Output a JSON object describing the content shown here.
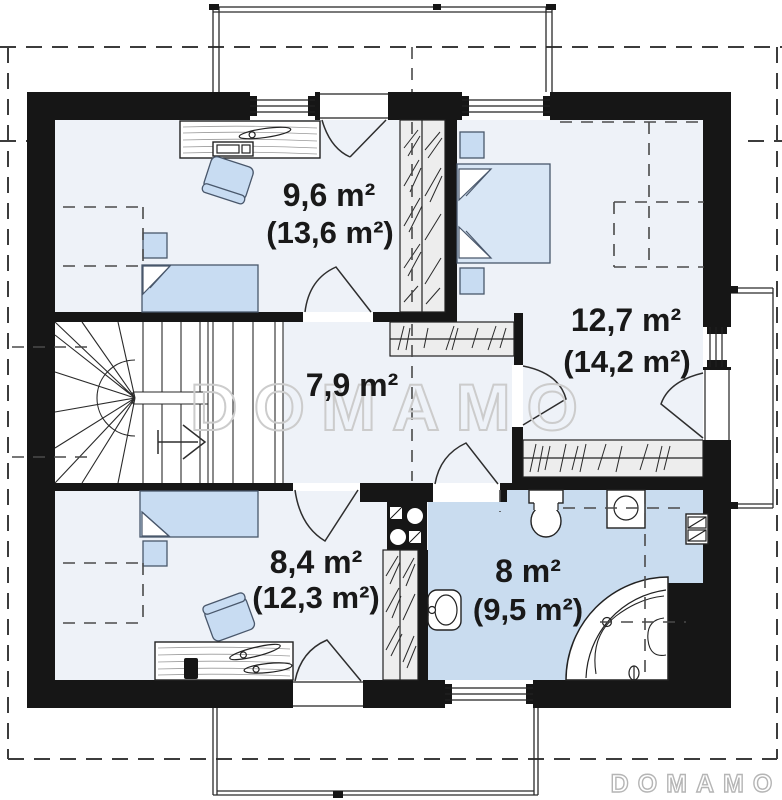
{
  "plan": {
    "rooms": [
      {
        "id": "room-top-left",
        "area": "9,6 m²",
        "total": "(13,6 m²)"
      },
      {
        "id": "room-top-right",
        "area": "12,7 m²",
        "total": "(14,2 m²)"
      },
      {
        "id": "hall",
        "area": "7,9 m²",
        "total": ""
      },
      {
        "id": "room-bottom-left",
        "area": "8,4 m²",
        "total": "(12,3 m²)"
      },
      {
        "id": "bathroom",
        "area": "8 m²",
        "total": "(9,5 m²)"
      }
    ],
    "watermark": {
      "center": "DOMAMO",
      "corner": "DOMAMO"
    },
    "colors": {
      "wall": "#161616",
      "floor": "#eef2f8",
      "bathroom_floor": "#c9dcef",
      "furniture": "#c8dcf2",
      "closet_fill": "#ededed"
    }
  }
}
